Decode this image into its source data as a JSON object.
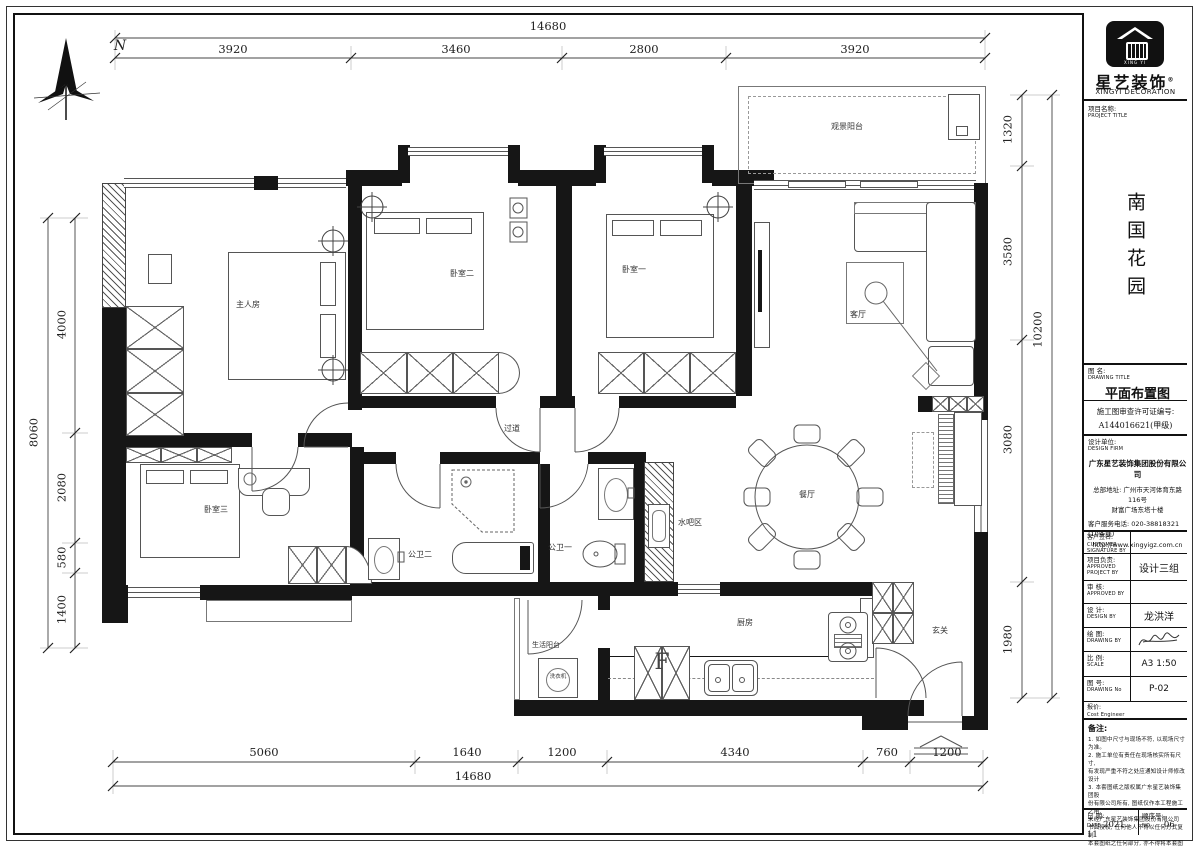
{
  "compass": {
    "north_label": "N"
  },
  "dims": {
    "top_total": "14680",
    "top": [
      "3920",
      "3460",
      "2800",
      "3920"
    ],
    "bottom": [
      "5060",
      "1640",
      "1200",
      "4340",
      "760",
      "1200"
    ],
    "bottom_total": "14680",
    "left": [
      "4000",
      "2080",
      "580",
      "1400"
    ],
    "left_total": "8060",
    "right": [
      "1320",
      "3580",
      "3080",
      "1980"
    ],
    "right_total": "10200"
  },
  "rooms": {
    "master": "主人房",
    "bedroom2": "卧室二",
    "bedroom1": "卧室一",
    "bedroom3": "卧室三",
    "living": "客厅",
    "dining": "餐厅",
    "view_balcony": "观景阳台",
    "corridor": "过道",
    "bath2": "公卫二",
    "bath1": "公卫一",
    "water_bar": "水吧区",
    "kitchen": "厨房",
    "entry": "玄关",
    "utility_balcony": "生活阳台",
    "washer": "洗衣机",
    "fridge": "F"
  },
  "titleblock": {
    "brand": {
      "cn": "星艺装饰",
      "en": "XINGYI DECORATION",
      "reg": "®",
      "logo_small": "XING YI"
    },
    "project": {
      "label_cn": "项目名称:",
      "label_en": "PROJECT TITLE",
      "name": "南国花园"
    },
    "drawing": {
      "label_cn": "图 名:",
      "label_en": "DRAWING TITLE",
      "title": "平面布置图"
    },
    "permit": {
      "line1": "施工图审查许可证编号:",
      "line2": "A144016621(甲级)"
    },
    "firm": {
      "label_cn": "设计单位:",
      "label_en": "DESIGN FIRM",
      "name": "广东星艺装饰集团股份有限公司",
      "addr1": "总部地址: 广州市天河体育东路116号",
      "addr2": "财富广场东塔十楼",
      "tel": "客户服务电话: 020-38818321 (10条线)",
      "url": "http://www.xingyigz.com.cn"
    },
    "customer": {
      "label_cn": "客户签名:",
      "label_en1": "CUSTOMER",
      "label_en2": "SIGNATURE BY"
    },
    "approved": {
      "label_cn": "项目负责:",
      "label_en1": "APPROVED",
      "label_en2": "PROJECT BY",
      "value": "设计三组"
    },
    "review": {
      "label_cn": "审 核:",
      "label_en1": "APPROVED BY",
      "value": ""
    },
    "design": {
      "label_cn": "设 计:",
      "label_en1": "DESIGN BY",
      "value": "龙洪洋"
    },
    "draw": {
      "label_cn": "绘 图:",
      "label_en1": "DRAWING BY"
    },
    "scale": {
      "label_cn": "比 例:",
      "label_en1": "SCALE",
      "value": "A3 1:50"
    },
    "number": {
      "label_cn": "图 号:",
      "label_en1": "DRAWING No",
      "value": "P-02"
    },
    "quote": {
      "label_cn": "报价:",
      "label_en1": "Cost Engineer"
    },
    "notes": {
      "title": "备注:",
      "lines": [
        "1. 如图中尺寸与现场不符, 以现场尺寸为准。",
        "2. 施工单位有责任在现场核实所有尺寸,",
        "有发现严重不符之处应通知设计师修改设计",
        "3. 本套图纸之版权属广东星艺装饰集团股",
        "份有限公司所有, 图纸仅作本工程施工之用,",
        "未经广东星艺装饰集团股份有限公司",
        "书面授权, 任何他人不得以任何方式复制",
        "本套图纸之任何部分, 亦不得将本套图纸",
        "用于其他任何用途。"
      ]
    },
    "date": {
      "label_cn": "日 期:",
      "label_en": "DATE",
      "value": "2021. 11"
    },
    "seq": {
      "label_cn": "顺序号:",
      "label_en": "NO.",
      "value": "06"
    }
  }
}
